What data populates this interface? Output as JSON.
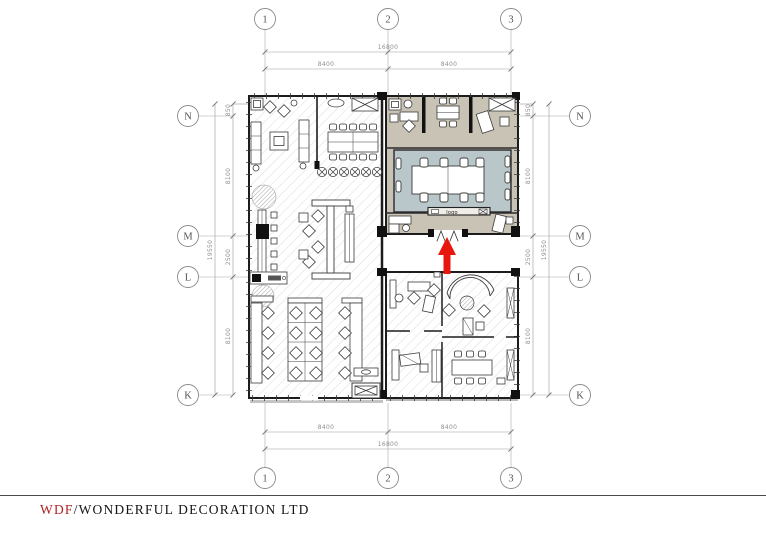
{
  "title_block": {
    "brand": "WDF",
    "separator": "/",
    "company": "WONDERFUL DECORATION LTD"
  },
  "grid": {
    "top": [
      {
        "label": "1"
      },
      {
        "label": "2"
      },
      {
        "label": "3"
      }
    ],
    "bottom": [
      {
        "label": "1"
      },
      {
        "label": "2"
      },
      {
        "label": "3"
      }
    ],
    "left": [
      {
        "label": "N"
      },
      {
        "label": "M"
      },
      {
        "label": "L"
      },
      {
        "label": "K"
      }
    ],
    "right": [
      {
        "label": "N"
      },
      {
        "label": "M"
      },
      {
        "label": "L"
      },
      {
        "label": "K"
      }
    ]
  },
  "dims": {
    "top": {
      "total": "16800",
      "seg1": "8400",
      "seg2": "8400"
    },
    "bottom": {
      "total": "16800",
      "seg1": "8400",
      "seg2": "8400"
    },
    "left": {
      "total": "19550",
      "seg_a": "850",
      "seg_b": "8100",
      "seg_c": "2500",
      "seg_d": "8100"
    },
    "right": {
      "total": "19550",
      "seg_a": "850",
      "seg_b": "8100",
      "seg_c": "2500",
      "seg_d": "8100"
    }
  },
  "plan": {
    "logo_label": "logo"
  },
  "colors": {
    "wall": "#1c1c1c",
    "room_tan": "#c8c3b5",
    "room_blue": "#b9c7cb",
    "hatch": "#dcdcdc",
    "arrow_red": "#e8170d",
    "brand_red": "#b22222"
  }
}
